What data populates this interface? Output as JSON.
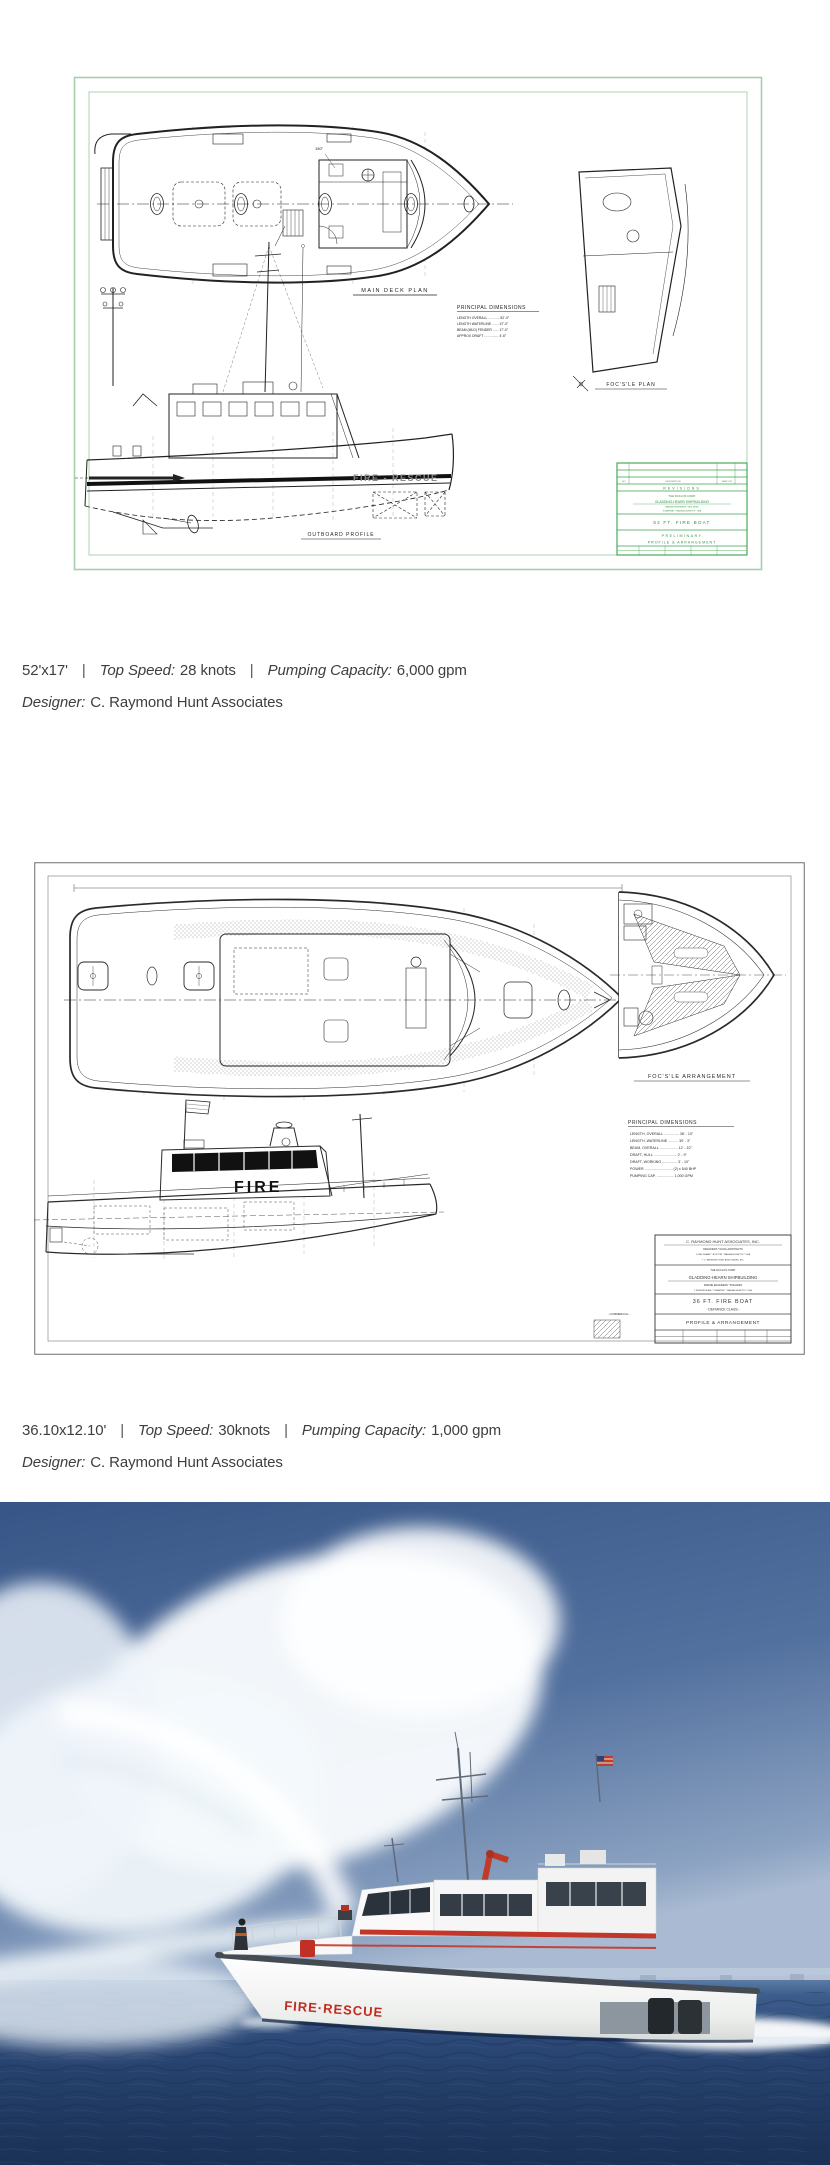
{
  "boat1": {
    "caption": {
      "dimensions": "52'x17'",
      "separator": "|",
      "top_speed_label": "Top Speed:",
      "top_speed_value": "28 knots",
      "pumping_label": "Pumping Capacity:",
      "pumping_value": "6,000 gpm",
      "designer_label": "Designer:",
      "designer_value": "C. Raymond Hunt Associates"
    },
    "drawing": {
      "ink": "#222222",
      "green_ink": "#3aa24a",
      "border_color": "#a6cfab",
      "labels": {
        "deck_plan": "MAIN DECK PLAN",
        "principal_dimensions": "PRINCIPAL DIMENSIONS",
        "dim1": "LENGTH OVERALL ............ 52'-0\"",
        "dim2": "LENGTH WATERLINE ....... 47'-0\"",
        "dim3": "BEAM (MLD) FENDER ...... 17'-0\"",
        "dim4": "APPROX DRAFT ............... 4'-6\"",
        "focsle_plan": "FOC'S'LE PLAN",
        "outboard_profile": "OUTBOARD PROFILE",
        "hull_text": "FIRE - RESCUE",
        "note_150": "150\""
      },
      "title_block": {
        "rev_no": "NO.",
        "rev_desc": "DESCRIPTION",
        "rev_date": "DATE / BY",
        "revisions": "REVISIONS",
        "company_line1": "THE DUCLOS CORP.",
        "company_line2": "GLADDING-HEARN SHIPBUILDING",
        "company_line3": "MARINE ENGINEERS * BUILDERS",
        "company_line4": "SOMERSET * MASSACHUSETTS * USA",
        "boat_title": "52 FT. FIRE BOAT",
        "status": "PRELIMINARY",
        "drawing_title": "PROFILE & ARRANGEMENT"
      }
    }
  },
  "boat2": {
    "caption": {
      "dimensions": "36.10x12.10'",
      "separator": "|",
      "top_speed_label": "Top Speed:",
      "top_speed_value": "30knots",
      "pumping_label": "Pumping Capacity:",
      "pumping_value": "1,000 gpm",
      "designer_label": "Designer:",
      "designer_value": "C. Raymond Hunt Associates"
    },
    "drawing": {
      "ink": "#2a2a2a",
      "labels": {
        "focsle_arrangement": "FOC'S'LE ARRANGEMENT",
        "principal_dimensions": "PRINCIPAL DIMENSIONS",
        "dim1": "LENGTH, OVERALL ............... 36' - 10\"",
        "dim2": "LENGTH, WATERLINE .......... 30' - 3\"",
        "dim3": "BEAM, OVERALL .................. 12' - 10\"",
        "dim4": "DRAFT, HULL ....................... 2' - 9\"",
        "dim5": "DRAFT, WORKING ............... 3' - 10\"",
        "dim6": "POWER ............................ (2) x 540 BHP",
        "dim7": "PUMPING CAP. ................. 1,000 GPM",
        "hull_text": "FIRE",
        "commercial": "- COMMERCIAL -"
      },
      "title_block": {
        "designer_line1": "C. RAYMOND HUNT ASSOCIATES, INC.",
        "designer_line2": "DESIGNERS * NAVAL ARCHITECTS",
        "designer_line3": "LONG WHARF * BOSTON * MASSACHUSETTS * USA",
        "designer_line4": "© C. RAYMOND HUNT ASSOCIATES, INC.",
        "builder_line1": "THE DUCLOS CORP.",
        "builder_line2": "GLADDING-HEARN SHIPBUILDING",
        "builder_line3": "MARINE ENGINEERS * BUILDERS",
        "builder_line4": "1 RIVERSIDE AVE * SOMERSET * MASSACHUSETTS * USA",
        "boat_title": "36 FT. FIRE BOAT",
        "boat_class": "- DEFIANCE CLASS -",
        "drawing_title": "PROFILE & ARRANGEMENT"
      }
    }
  },
  "photo": {
    "hull_text": "FIRE·RESCUE",
    "colors": {
      "sky_top": "#375586",
      "sky_horizon": "#a9bad2",
      "sea_deep": "#1b3156",
      "boat_white": "#f5f6f4",
      "accent_red": "#c02b20",
      "shore_haze": "#b6c2d4"
    }
  }
}
